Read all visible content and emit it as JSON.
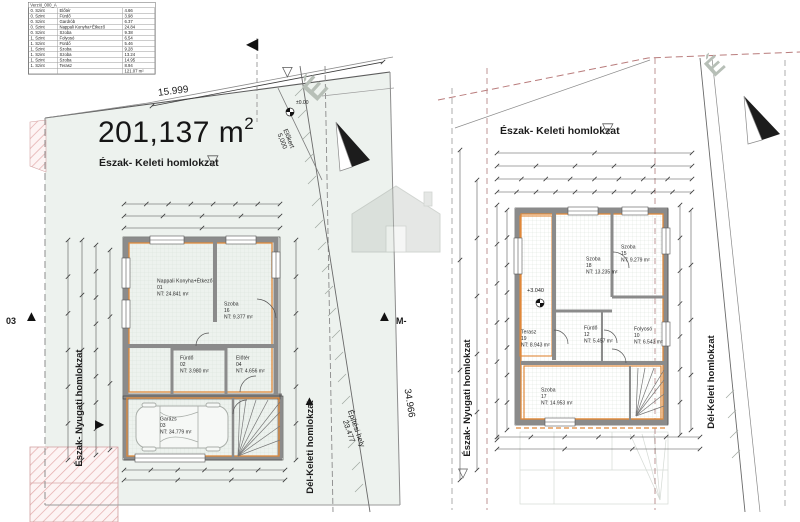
{
  "area_table": {
    "header": "Verzió_000_A",
    "rows": [
      {
        "level": "0. Szint",
        "room": "Előtér",
        "area": "4.66"
      },
      {
        "level": "0. Szint",
        "room": "Fürdő",
        "area": "3.98"
      },
      {
        "level": "0. Szint",
        "room": "Gardrób",
        "area": "6.37"
      },
      {
        "level": "0. Szint",
        "room": "Nappali Konyha+Étkező",
        "area": "24.84"
      },
      {
        "level": "0. Szint",
        "room": "Szoba",
        "area": "9.38"
      },
      {
        "level": "1. Szint",
        "room": "Folyosó",
        "area": "6.54"
      },
      {
        "level": "1. Szint",
        "room": "Fürdő",
        "area": "5.46"
      },
      {
        "level": "1. Szint",
        "room": "Szoba",
        "area": "9.28"
      },
      {
        "level": "1. Szint",
        "room": "Szoba",
        "area": "13.24"
      },
      {
        "level": "1. Szint",
        "room": "Szoba",
        "area": "14.95"
      },
      {
        "level": "1. Szint",
        "room": "Terasz",
        "area": "8.94"
      }
    ],
    "total": "121.07 m²"
  },
  "site": {
    "area_value": "201,137 m",
    "area_exp": "2",
    "dim_top": "15.999",
    "dim_right": "34.966",
    "front_setback_label": "Előkert",
    "front_setback_value": "5,000",
    "building_zone_label": "Építési hely",
    "building_zone_value": "23.477",
    "level_zero": "±0.00",
    "marker_left": "03",
    "marker_right": "M-",
    "north_letter": "É"
  },
  "facades": {
    "north_east": "Észak- Keleti homlokzat",
    "north_west": "Észak- Nyugati homlokzat",
    "south_east": "Dél-Keleti homlokzat"
  },
  "ground_floor": {
    "rooms": [
      {
        "name": "Nappali Konyha+Étkező",
        "num": "01",
        "area": "NT: 24.841 m²"
      },
      {
        "name": "Szoba",
        "num": "16",
        "area": "NT: 9.377 m²"
      },
      {
        "name": "Fürdő",
        "num": "02",
        "area": "NT: 3.980 m²"
      },
      {
        "name": "Előtér",
        "num": "04",
        "area": "NT: 4.656 m²"
      },
      {
        "name": "Garázs",
        "num": "03",
        "area": "NT: 34.779 m²"
      }
    ]
  },
  "upper_floor": {
    "level_mark": "+3.040",
    "north_letter": "É",
    "rooms": [
      {
        "name": "Szoba",
        "num": "18",
        "area": "NT: 13.235 m²"
      },
      {
        "name": "Szoba",
        "num": "15",
        "area": "NT: 9.279 m²"
      },
      {
        "name": "Terasz",
        "num": "19",
        "area": "NT: 8.943 m²"
      },
      {
        "name": "Fürdő",
        "num": "12",
        "area": "NT: 5.457 m²"
      },
      {
        "name": "Folyosó",
        "num": "10",
        "area": "NT: 6.543 m²"
      },
      {
        "name": "Szoba",
        "num": "17",
        "area": "NT: 14.953 m²"
      }
    ]
  },
  "icons": {
    "tri_down_white": "▽",
    "tri_up_black": "▲",
    "tri_left_black": "◀",
    "tri_right_black": "▶"
  },
  "colors": {
    "accent_orange": "#e0893a",
    "boundary_red": "#b97c7c",
    "site_fill": "#edf2ee",
    "wall_grey": "#8b8b8b"
  }
}
